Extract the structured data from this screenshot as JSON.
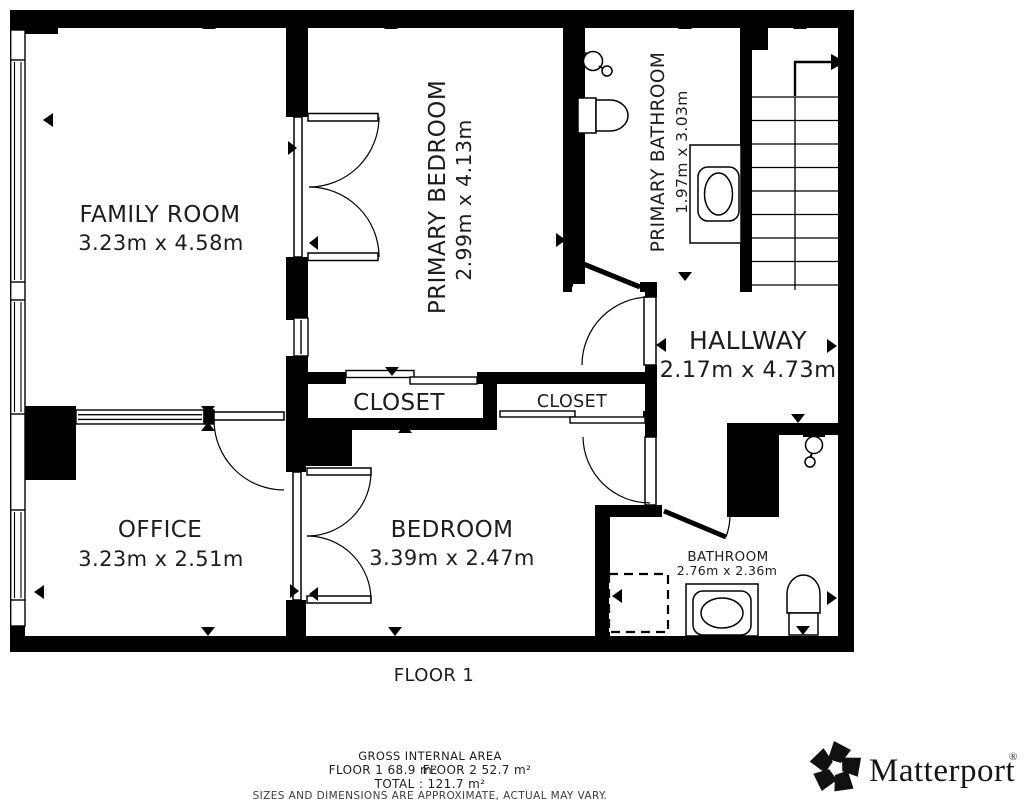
{
  "floor": {
    "label": "FLOOR 1"
  },
  "rooms": {
    "family_room": {
      "name": "FAMILY ROOM",
      "dims": "3.23m x 4.58m"
    },
    "primary_bedroom": {
      "name": "PRIMARY BEDROOM",
      "dims": "2.99m x 4.13m"
    },
    "primary_bathroom": {
      "name": "PRIMARY BATHROOM",
      "dims": "1.97m x 3.03m"
    },
    "hallway": {
      "name": "HALLWAY",
      "dims": "2.17m x 4.73m"
    },
    "closet_large": {
      "name": "CLOSET"
    },
    "closet_small": {
      "name": "CLOSET"
    },
    "office": {
      "name": "OFFICE",
      "dims": "3.23m x 2.51m"
    },
    "bedroom": {
      "name": "BEDROOM",
      "dims": "3.39m x 2.47m"
    },
    "bathroom": {
      "name": "BATHROOM",
      "dims": "2.76m x 2.36m"
    }
  },
  "footer": {
    "gross_title": "GROSS INTERNAL AREA",
    "floor1_area": "FLOOR 1 68.9 m²",
    "floor2_area": "FLOOR 2 52.7 m²",
    "total": "TOTAL :  121.7 m²",
    "disclaimer": "SIZES AND DIMENSIONS ARE APPROXIMATE, ACTUAL MAY VARY."
  },
  "brand": {
    "name": "Matterport",
    "mark": "®"
  },
  "colors": {
    "wall": "#000000",
    "background": "#ffffff",
    "text": "#1d1d1d"
  }
}
